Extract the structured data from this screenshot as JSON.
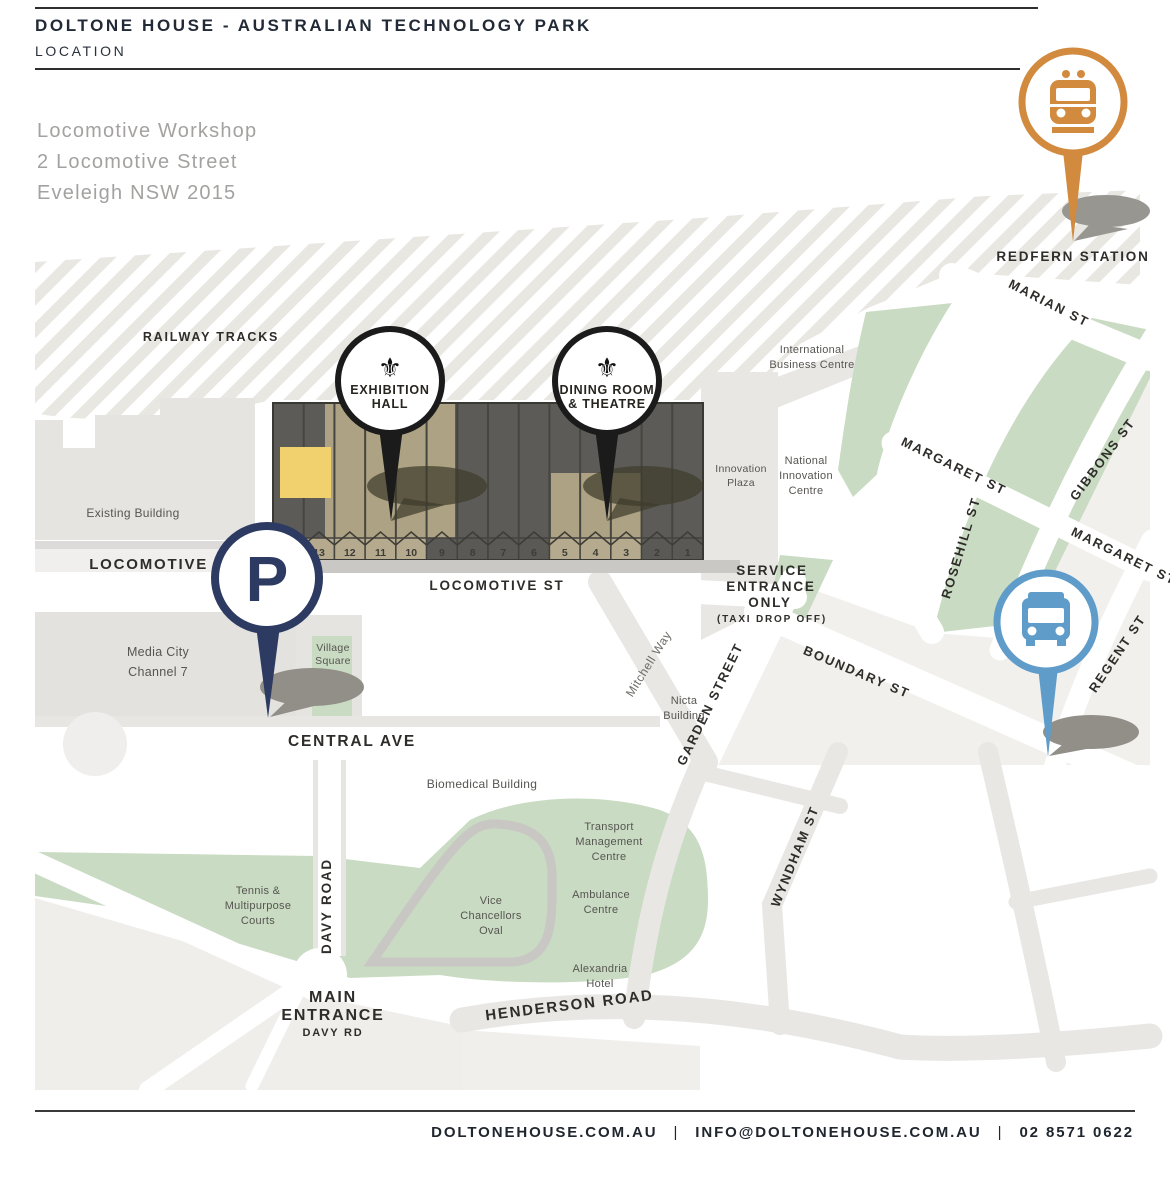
{
  "header": {
    "title": "DOLTONE HOUSE - AUSTRALIAN TECHNOLOGY PARK",
    "subtitle": "LOCATION",
    "address_lines": [
      "Locomotive Workshop",
      "2 Locomotive Street",
      "Eveleigh NSW 2015"
    ]
  },
  "footer": {
    "items": [
      "DOLTONEHOUSE.COM.AU",
      "INFO@DOLTONEHOUSE.COM.AU",
      "02 8571 0622"
    ],
    "separator": "|"
  },
  "map": {
    "fleur_glyph": "⚜",
    "street_labels": [
      {
        "t": "RAILWAY TRACKS",
        "x": 211,
        "y": 341,
        "r": 0,
        "s": 12.5
      },
      {
        "t": "LOCOMOTIVE ST",
        "x": 163,
        "y": 569,
        "r": 0,
        "s": 15
      },
      {
        "t": "LOCOMOTIVE ST",
        "x": 497,
        "y": 590,
        "r": 0,
        "s": 13.5
      },
      {
        "t": "CENTRAL AVE",
        "x": 352,
        "y": 746,
        "r": 0,
        "s": 15.5
      },
      {
        "t": "MARIAN ST",
        "x": 1047,
        "y": 307,
        "r": 27,
        "s": 13
      },
      {
        "t": "MARGARET ST",
        "x": 952,
        "y": 470,
        "r": 26,
        "s": 13
      },
      {
        "t": "GIBBONS ST",
        "x": 1106,
        "y": 462,
        "r": -53,
        "s": 13
      },
      {
        "t": "ROSEHILL ST",
        "x": 965,
        "y": 549,
        "r": -73,
        "s": 13
      },
      {
        "t": "MARGARET ST",
        "x": 1122,
        "y": 560,
        "r": 26,
        "s": 13
      },
      {
        "t": "REGENT ST",
        "x": 1121,
        "y": 656,
        "r": -56,
        "s": 13
      },
      {
        "t": "BOUNDARY ST",
        "x": 855,
        "y": 676,
        "r": 23,
        "s": 13
      },
      {
        "t": "GARDEN STREET",
        "x": 714,
        "y": 706,
        "r": -64,
        "s": 13
      },
      {
        "t": "WYNDHAM ST",
        "x": 799,
        "y": 858,
        "r": -68,
        "s": 13
      },
      {
        "t": "DAVY ROAD",
        "x": 331,
        "y": 906,
        "r": -90,
        "s": 13.5
      },
      {
        "t": "HENDERSON ROAD",
        "x": 570,
        "y": 1010,
        "r": -7,
        "s": 15
      },
      {
        "t": "Mitchell Way",
        "x": 652,
        "y": 666,
        "r": -58,
        "s": 12,
        "cls": "way"
      }
    ],
    "place_labels": [
      {
        "lines": [
          "Existing Building"
        ],
        "x": 133,
        "y": 517,
        "s": 12
      },
      {
        "lines": [
          "Media City",
          "Channel 7"
        ],
        "x": 158,
        "y": 656,
        "s": 12.5,
        "lh": 20
      },
      {
        "lines": [
          "Village",
          "Square"
        ],
        "x": 333,
        "y": 651,
        "s": 10.5,
        "lh": 13
      },
      {
        "lines": [
          "Innovation",
          "Plaza"
        ],
        "x": 741,
        "y": 472,
        "s": 10.5,
        "lh": 14
      },
      {
        "lines": [
          "National",
          "Innovation",
          "Centre"
        ],
        "x": 806,
        "y": 464,
        "s": 11,
        "lh": 15
      },
      {
        "lines": [
          "International",
          "Business Centre"
        ],
        "x": 812,
        "y": 353,
        "s": 11,
        "lh": 15
      },
      {
        "lines": [
          "Nicta",
          "Building"
        ],
        "x": 684,
        "y": 704,
        "s": 11,
        "lh": 15
      },
      {
        "lines": [
          "Biomedical Building"
        ],
        "x": 482,
        "y": 788,
        "s": 12
      },
      {
        "lines": [
          "Transport",
          "Management",
          "Centre"
        ],
        "x": 609,
        "y": 830,
        "s": 11,
        "lh": 15
      },
      {
        "lines": [
          "Ambulance",
          "Centre"
        ],
        "x": 601,
        "y": 898,
        "s": 11,
        "lh": 15
      },
      {
        "lines": [
          "Alexandria",
          "Hotel"
        ],
        "x": 600,
        "y": 972,
        "s": 11,
        "lh": 15
      },
      {
        "lines": [
          "Tennis &",
          "Multipurpose",
          "Courts"
        ],
        "x": 258,
        "y": 894,
        "s": 11,
        "lh": 15
      },
      {
        "lines": [
          "Vice",
          "Chancellors",
          "Oval"
        ],
        "x": 491,
        "y": 904,
        "s": 11,
        "lh": 15
      }
    ],
    "bays": [
      {
        "n": "14",
        "tan": true
      },
      {
        "n": "13",
        "tan": true
      },
      {
        "n": "12",
        "tan": true
      },
      {
        "n": "11",
        "tan": true
      },
      {
        "n": "10",
        "tan": true
      },
      {
        "n": "9",
        "tan": false
      },
      {
        "n": "8",
        "tan": false
      },
      {
        "n": "7",
        "tan": false
      },
      {
        "n": "6",
        "tan": false
      },
      {
        "n": "5",
        "tan": true
      },
      {
        "n": "4",
        "tan": true
      },
      {
        "n": "3",
        "tan": true
      },
      {
        "n": "2",
        "tan": false
      },
      {
        "n": "1",
        "tan": false
      }
    ],
    "markers": {
      "exhibition": {
        "icon": "fleur-de-lis",
        "lines": [
          "EXHIBITION",
          "HALL"
        ]
      },
      "dining": {
        "icon": "fleur-de-lis",
        "lines": [
          "DINING ROOM",
          "& THEATRE"
        ]
      },
      "parking": {
        "letter": "P"
      },
      "bus": {
        "icon": "bus"
      },
      "train": {
        "icon": "train",
        "label": "REDFERN STATION"
      }
    },
    "service": {
      "lines": [
        "SERVICE",
        "ENTRANCE",
        "ONLY"
      ],
      "taxi": "(TAXI DROP OFF)"
    },
    "entrance": {
      "lines": [
        "MAIN",
        "ENTRANCE"
      ],
      "sub": "DAVY RD"
    }
  },
  "colors": {
    "accent_orange": "#d28a3e",
    "accent_blue": "#5f9cc9",
    "navy": "#2d3a61",
    "building_dark": "#5d5b57",
    "building_tan": "#ada283",
    "highlight_yellow": "#f1d16e",
    "park_green": "#c9dbc2",
    "ink": "#212a36"
  }
}
